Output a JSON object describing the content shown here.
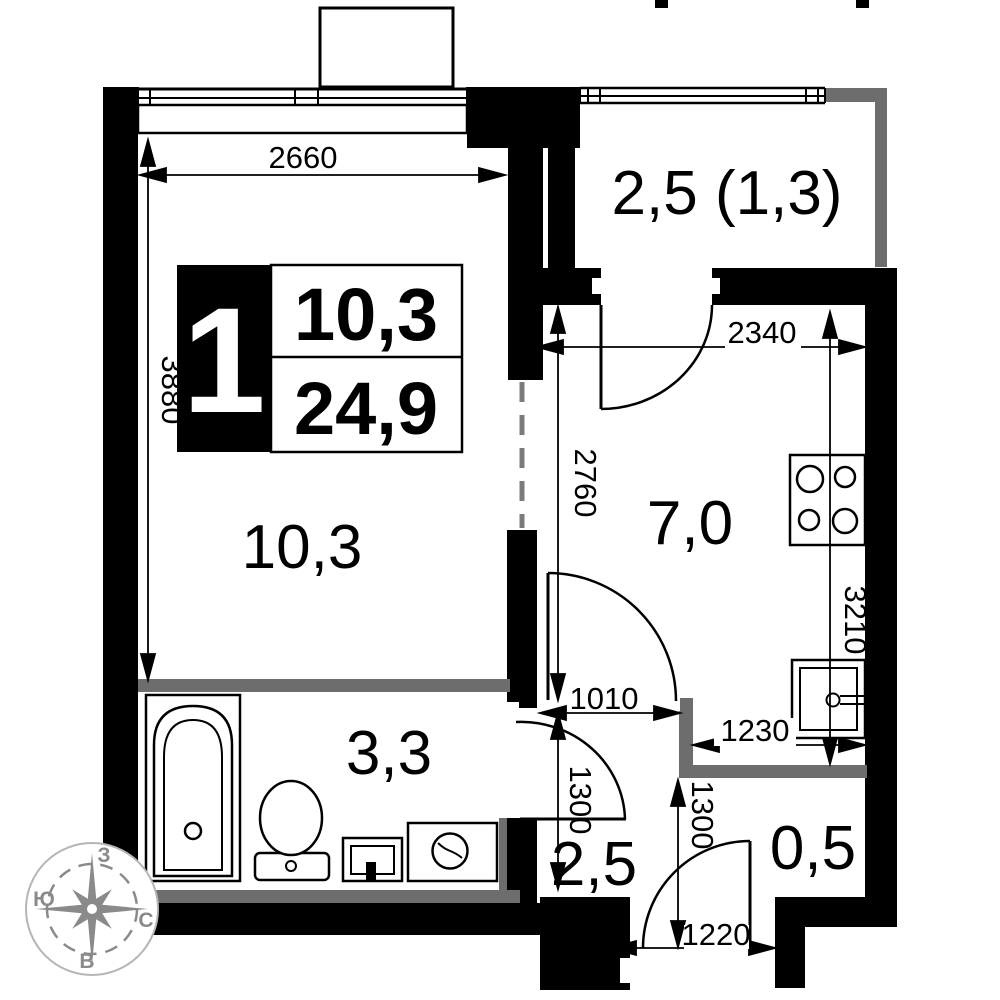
{
  "plan": {
    "unit_badge": {
      "rooms": "1",
      "area_living": "10,3",
      "area_total": "24,9"
    },
    "room_labels": {
      "living": "10,3",
      "kitchen": "7,0",
      "balcony": "2,5 (1,3)",
      "bathroom": "3,3",
      "hallway": "2,5",
      "closet": "0,5"
    },
    "dimensions": {
      "living_width": "2660",
      "living_height": "3880",
      "kitchen_width": "2340",
      "kitchen_height": "2760",
      "kitchen_right_height": "3210",
      "kitchen_door_width": "1010",
      "hall_height": "1300",
      "entry_height": "1300",
      "kitchen_bottom_width": "1230",
      "entry_door_width": "1220"
    },
    "compass": {
      "top": "З",
      "left": "Ю",
      "right": "С",
      "bottom": "В"
    },
    "colors": {
      "wall": "#000000",
      "partition": "#6d6d6d",
      "compass": "#8a8a8a"
    }
  }
}
